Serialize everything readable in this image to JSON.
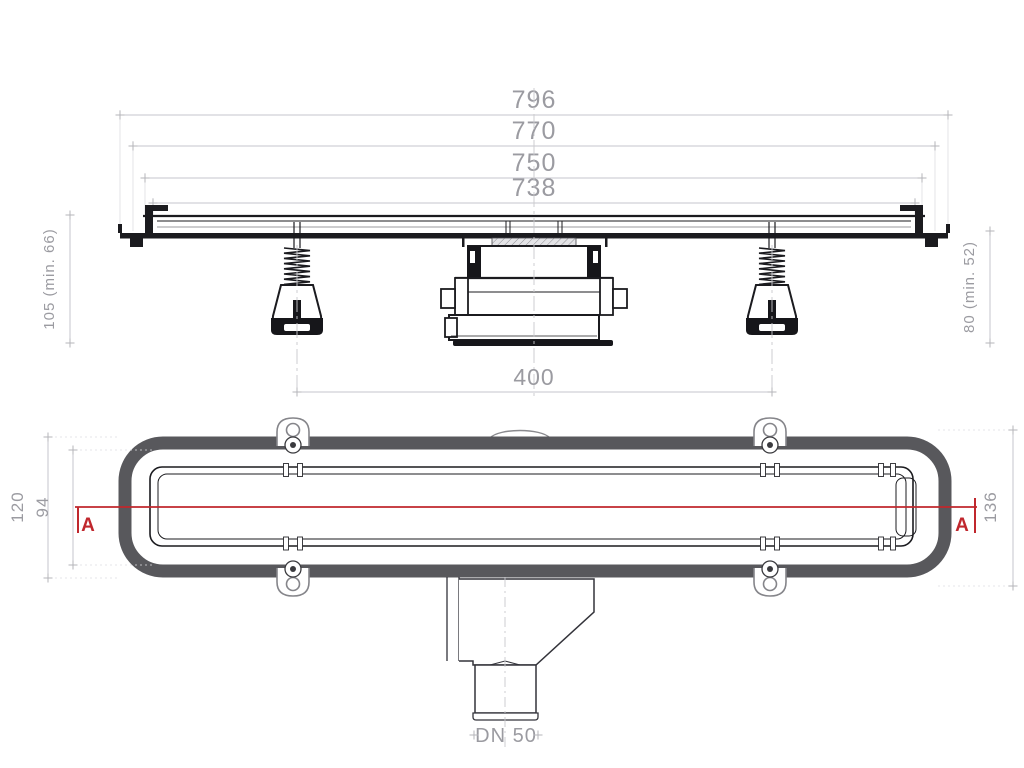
{
  "drawing": {
    "type": "linear-shower-drain-technical-drawing",
    "view_top": {
      "width_dims": {
        "outer": "796",
        "lip": "770",
        "body": "750",
        "inner": "738"
      },
      "height_left": "105 (min. 66)",
      "height_right": "80 (min. 52)",
      "feet_spacing": "400"
    },
    "view_plan": {
      "height_outer": "120",
      "height_channel": "94",
      "height_total": "136",
      "section_left": "A",
      "section_right": "A",
      "outlet": "DN 50"
    },
    "colors": {
      "line": "#1b1b1f",
      "dim_line": "#c2c2c8",
      "dim_text": "#9b9ba1",
      "frame_gray": "#58585c",
      "section_red": "#c0272d",
      "background": "#ffffff"
    }
  }
}
